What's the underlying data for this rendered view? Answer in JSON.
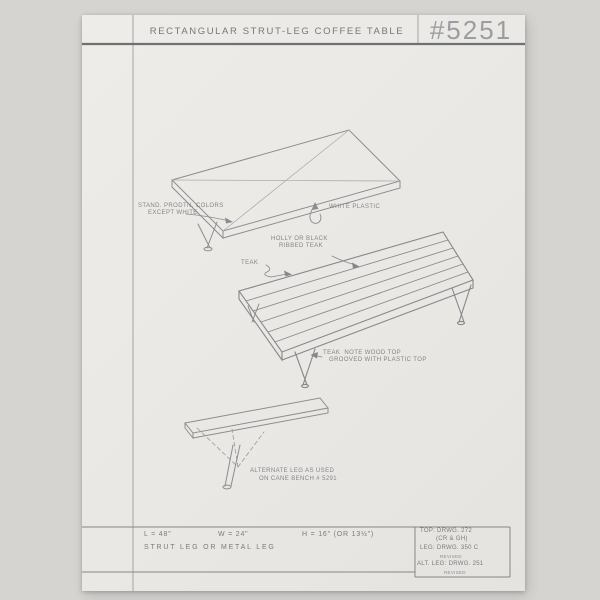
{
  "document": {
    "title": "RECTANGULAR STRUT-LEG COFFEE TABLE",
    "drawing_number": "#5251"
  },
  "annotations": {
    "top_view": {
      "finish_note_1": "STAND. PRODTN. COLORS",
      "finish_note_2": "EXCEPT WHITE",
      "material": "WHITE PLASTIC"
    },
    "middle_view": {
      "ribbed_note_1": "HOLLY OR BLACK",
      "ribbed_note_2": "RIBBED TEAK",
      "material": "TEAK",
      "wood_top_note_1": "TEAK  NOTE WOOD TOP",
      "wood_top_note_2": "GROOVED WITH PLASTIC TOP"
    },
    "bottom_view": {
      "alt_leg_note_1": "ALTERNATE LEG AS USED",
      "alt_leg_note_2": "ON CANE BENCH # 5291"
    }
  },
  "dimensions": {
    "length": "L = 48\"",
    "width": "W = 24\"",
    "height": "H = 16\" (OR 13½\")",
    "leg_options": "STRUT LEG OR METAL LEG"
  },
  "reference_box": {
    "top_ref": "TOP: DRWG. 272",
    "top_ref_sub": "(CR & GH)",
    "leg_ref": "LEG: DRWG. 350 C",
    "leg_ref_sub": "REVISED",
    "alt_leg_ref": "ALT. LEG: DRWG. 251",
    "alt_leg_ref_sub": "REVISED"
  },
  "colors": {
    "background": "#d6d4d1",
    "paper": "#eae8e4",
    "pencil": "#85878b",
    "pencil_light": "#aaacaf",
    "heavy_rule": "#6e7074",
    "number_pencil": "#9b9da0"
  }
}
